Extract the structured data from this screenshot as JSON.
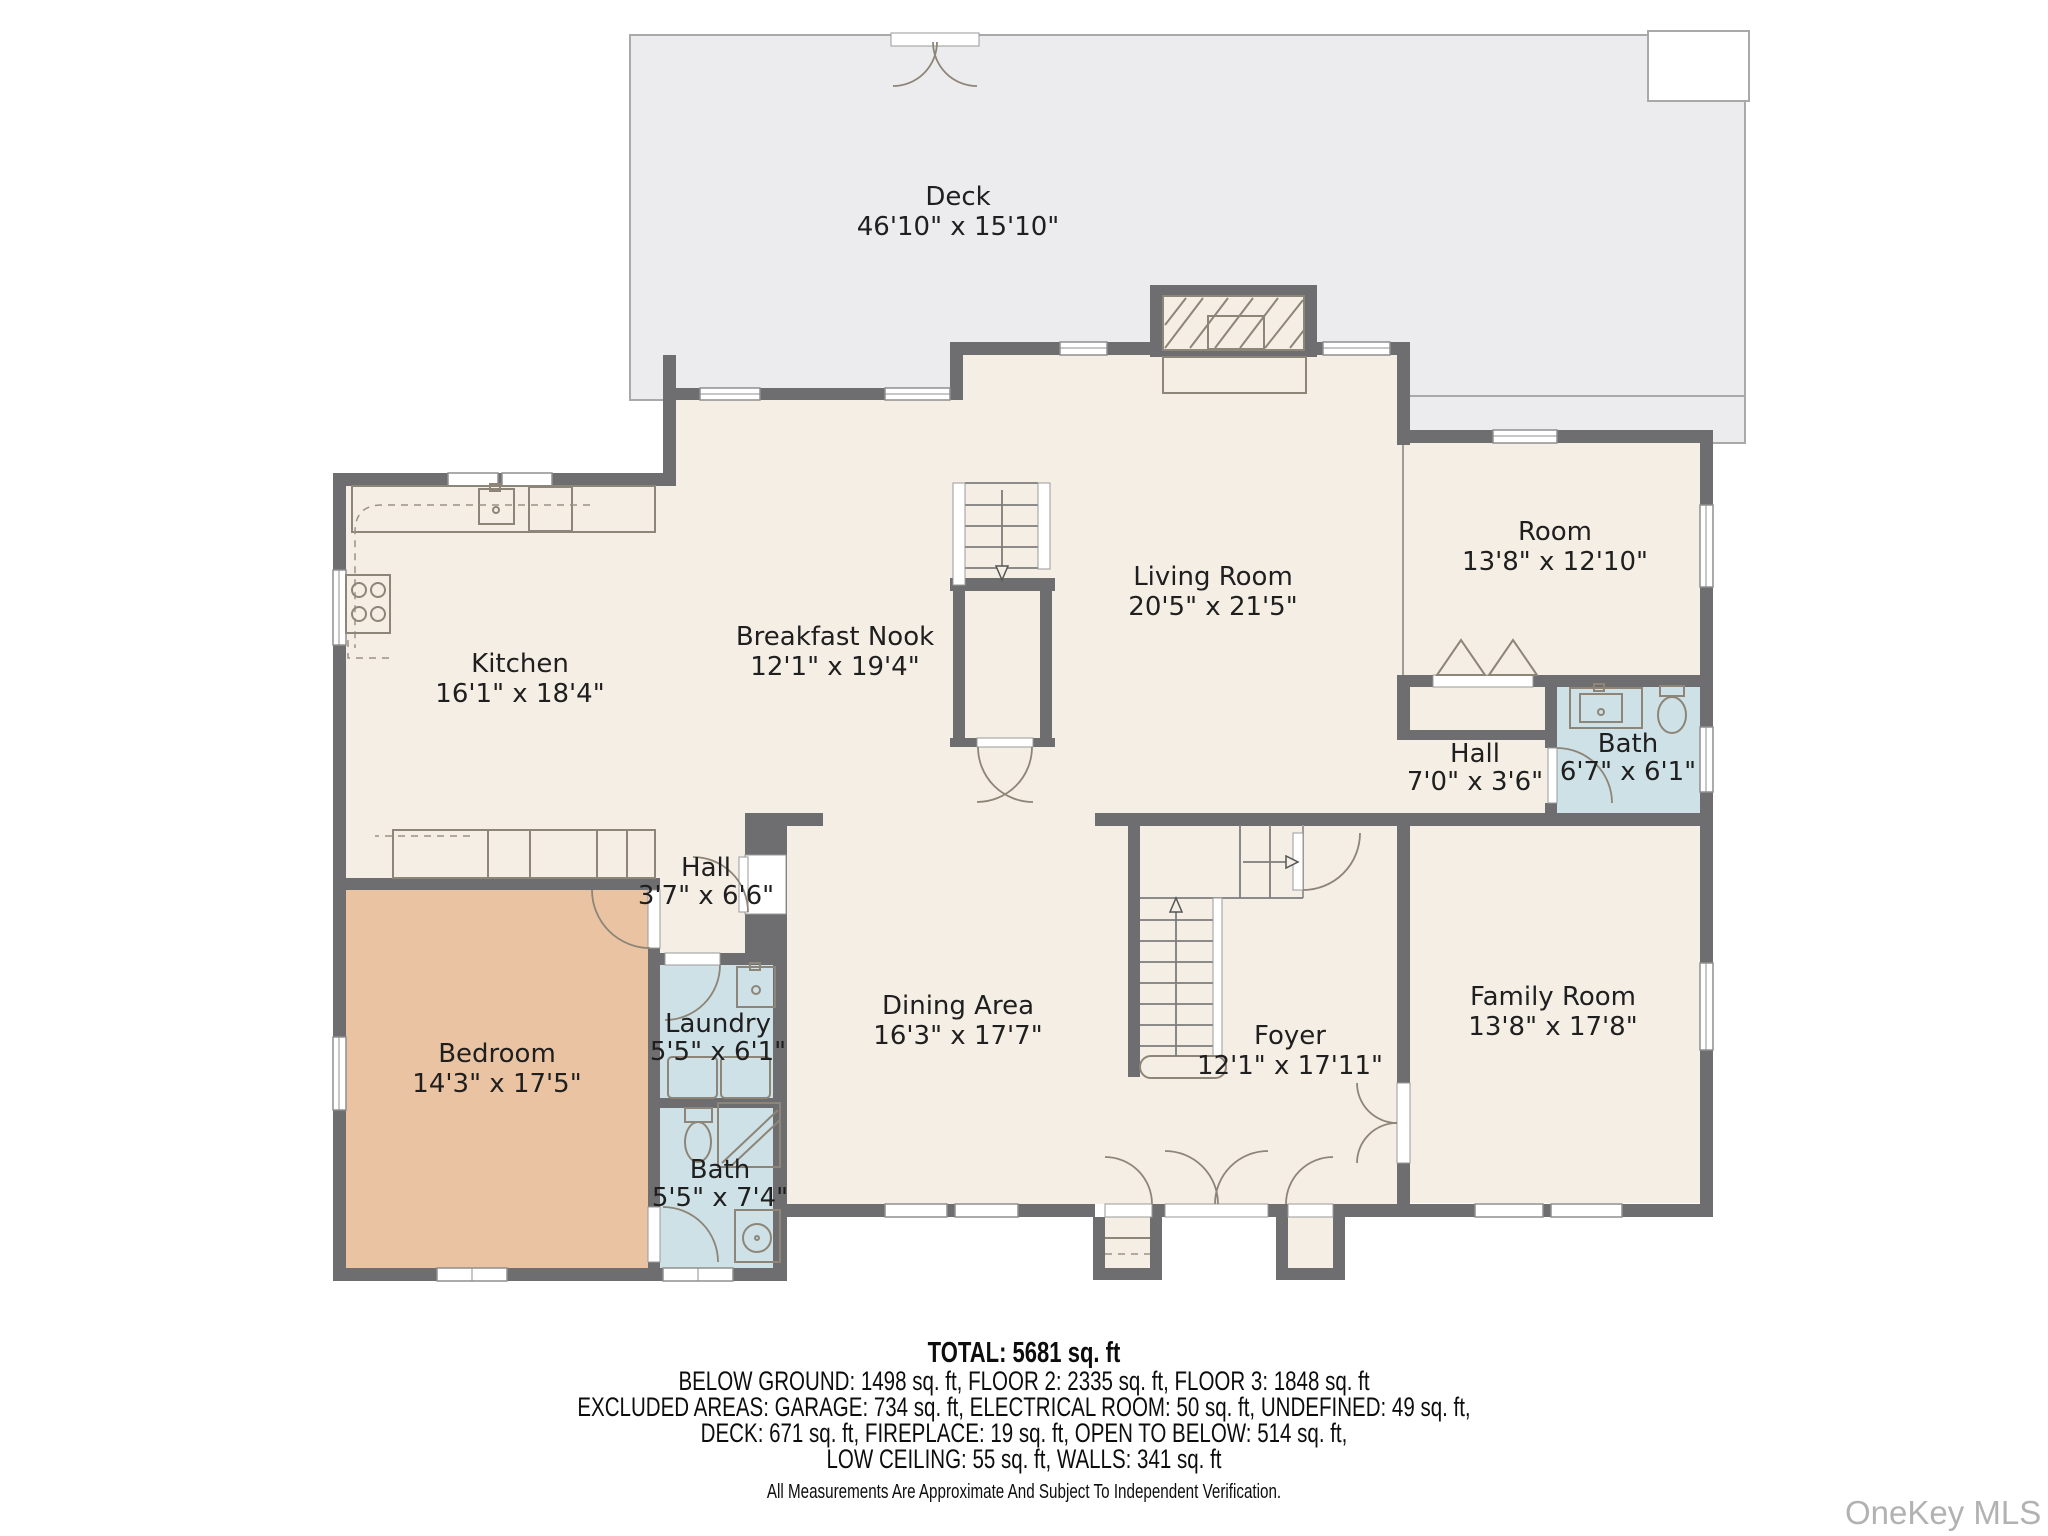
{
  "title": "Floor plan",
  "watermark": "OneKey MLS",
  "colors": {
    "wall": "#6e6e70",
    "floor": "#f5eee5",
    "deck": "#ececee",
    "wet_room": "#cee1e6",
    "bedroom": "#eac4a2",
    "label_text": "#1f1f1f",
    "watermark_text": "#b2b2b2"
  },
  "rooms": {
    "deck": {
      "name": "Deck",
      "dims": "46'10\" x 15'10\""
    },
    "kitchen": {
      "name": "Kitchen",
      "dims": "16'1\" x 18'4\""
    },
    "nook": {
      "name": "Breakfast Nook",
      "dims": "12'1\" x 19'4\""
    },
    "living": {
      "name": "Living Room",
      "dims": "20'5\" x 21'5\""
    },
    "room": {
      "name": "Room",
      "dims": "13'8\" x 12'10\""
    },
    "hall_right": {
      "name": "Hall",
      "dims": "7'0\" x 3'6\""
    },
    "bath_right": {
      "name": "Bath",
      "dims": "6'7\" x 6'1\""
    },
    "family": {
      "name": "Family Room",
      "dims": "13'8\" x 17'8\""
    },
    "foyer": {
      "name": "Foyer",
      "dims": "12'1\" x 17'11\""
    },
    "dining": {
      "name": "Dining Area",
      "dims": "16'3\" x 17'7\""
    },
    "hall_left": {
      "name": "Hall",
      "dims": "3'7\" x 6'6\""
    },
    "laundry": {
      "name": "Laundry",
      "dims": "5'5\" x 6'1\""
    },
    "bath_left": {
      "name": "Bath",
      "dims": "5'5\" x 7'4\""
    },
    "bedroom": {
      "name": "Bedroom",
      "dims": "14'3\" x 17'5\""
    }
  },
  "summary": {
    "total": "TOTAL: 5681 sq. ft",
    "line1": "BELOW GROUND: 1498 sq. ft, FLOOR 2: 2335 sq. ft, FLOOR 3: 1848 sq. ft",
    "line2": "EXCLUDED AREAS: GARAGE: 734 sq. ft, ELECTRICAL ROOM: 50 sq. ft, UNDEFINED: 49 sq. ft,",
    "line3": "DECK: 671 sq. ft, FIREPLACE: 19 sq. ft, OPEN TO BELOW: 514 sq. ft,",
    "line4": "LOW CEILING: 55 sq. ft, WALLS: 341 sq. ft",
    "disclaimer": "All Measurements Are Approximate And Subject To Independent Verification."
  }
}
